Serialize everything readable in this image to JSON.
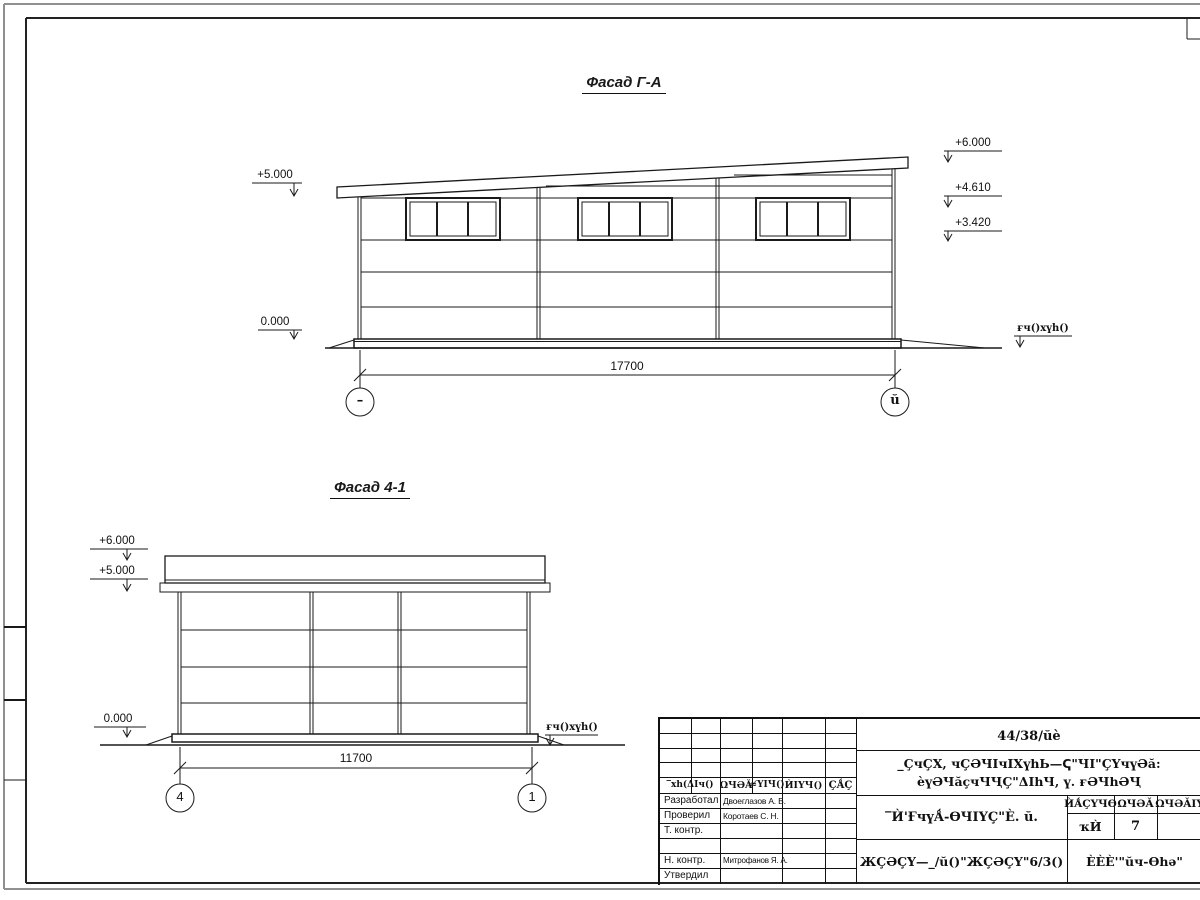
{
  "colors": {
    "line": "#1a1a1a",
    "frame_outer": "#909090"
  },
  "facade_ga": {
    "title": "Фасад Г-А",
    "elevations_left": [
      "+5.000",
      "0.000"
    ],
    "elevations_right": [
      "+6.000",
      "+4.610",
      "+3.420"
    ],
    "ground_label": "ғч()хүһ()",
    "dimension": "17700",
    "axis_left": "–",
    "axis_right": "ŭ"
  },
  "facade_41": {
    "title": "Фасад 4-1",
    "elevations_left": [
      "+6.000",
      "+5.000",
      "0.000"
    ],
    "ground_label": "ғч()хүһ()",
    "dimension": "11700",
    "axis_left": "4",
    "axis_right": "1"
  },
  "title_block": {
    "doc_number": "44/38/ŭè",
    "project_line1": "_ÇчÇХ, чÇӘЧIчIХүһЬ—Ҁ\"ЧI\"ÇҮчүӘă:",
    "project_line2": "èүӘЧăçчЧҶÇ\"ΔIһЧ, ү. ғӘЧһӘҶ",
    "sheet_title": "‾Ѝ'ҒчүǺ-ѲЧIҮÇ\"È. ŭ.",
    "org_line": "ЖÇӘÇҮ—_/ŭ()\"ЖÇӘÇҮ\"6/3()",
    "corner_label": "ÈÈÈ'\"ŭч-Ѳһә\"",
    "header_cols": [
      "‾хh(ΔIч()",
      "ΩЧӘǍ",
      "≉ҮIЧ()",
      "ЍIҮЧ()",
      "ÇǺÇ"
    ],
    "stage_headers": [
      "ЍǺÇҮЧѲ",
      "ΩЧӘǍ",
      "ΩЧӘǍIҮ"
    ],
    "stage_values": [
      "ҡЍ",
      "7"
    ],
    "rows": [
      {
        "role": "Разработал",
        "name": "Двоеглазов А. В."
      },
      {
        "role": "Проверил",
        "name": "Коротаев С. Н."
      },
      {
        "role": "Т. контр.",
        "name": ""
      },
      {
        "role": "",
        "name": ""
      },
      {
        "role": "Н. контр.",
        "name": "Митрофанов Я. А."
      },
      {
        "role": "Утвердил",
        "name": ""
      }
    ]
  }
}
